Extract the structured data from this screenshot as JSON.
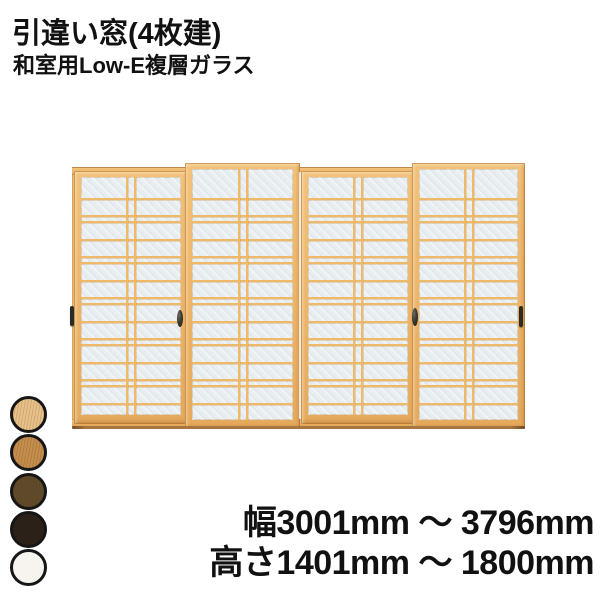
{
  "header": {
    "title": "引違い窓(4枚建)",
    "subtitle": "和室用Low-E複層ガラス"
  },
  "product_image": {
    "description": "4-panel sliding shoji-style window with wood-tone frame and Low-E double glazing",
    "panel_count": 4,
    "palette": {
      "frame_wood": "#ecb467",
      "frame_wood_light": "#f4c883",
      "frame_wood_dark": "#cf9349",
      "glass": "#e9eef1",
      "kumiko_grid": "#eeba6a",
      "handle": "#2c2c27",
      "sill_shadow": "#a9763f"
    }
  },
  "color_swatches": [
    {
      "name": "light-wood",
      "color": "#e9c28a",
      "grain": true
    },
    {
      "name": "medium-wood",
      "color": "#c48e4d",
      "grain": true
    },
    {
      "name": "dark-wood",
      "color": "#5f4b2b",
      "grain": true
    },
    {
      "name": "dark-brown",
      "color": "#2b2118",
      "grain": false
    },
    {
      "name": "white",
      "color": "#f7f4ef",
      "grain": false
    }
  ],
  "dimensions": {
    "width_range": "幅3001mm ～ 3796mm",
    "height_range": "高さ1401mm ～ 1800mm"
  }
}
